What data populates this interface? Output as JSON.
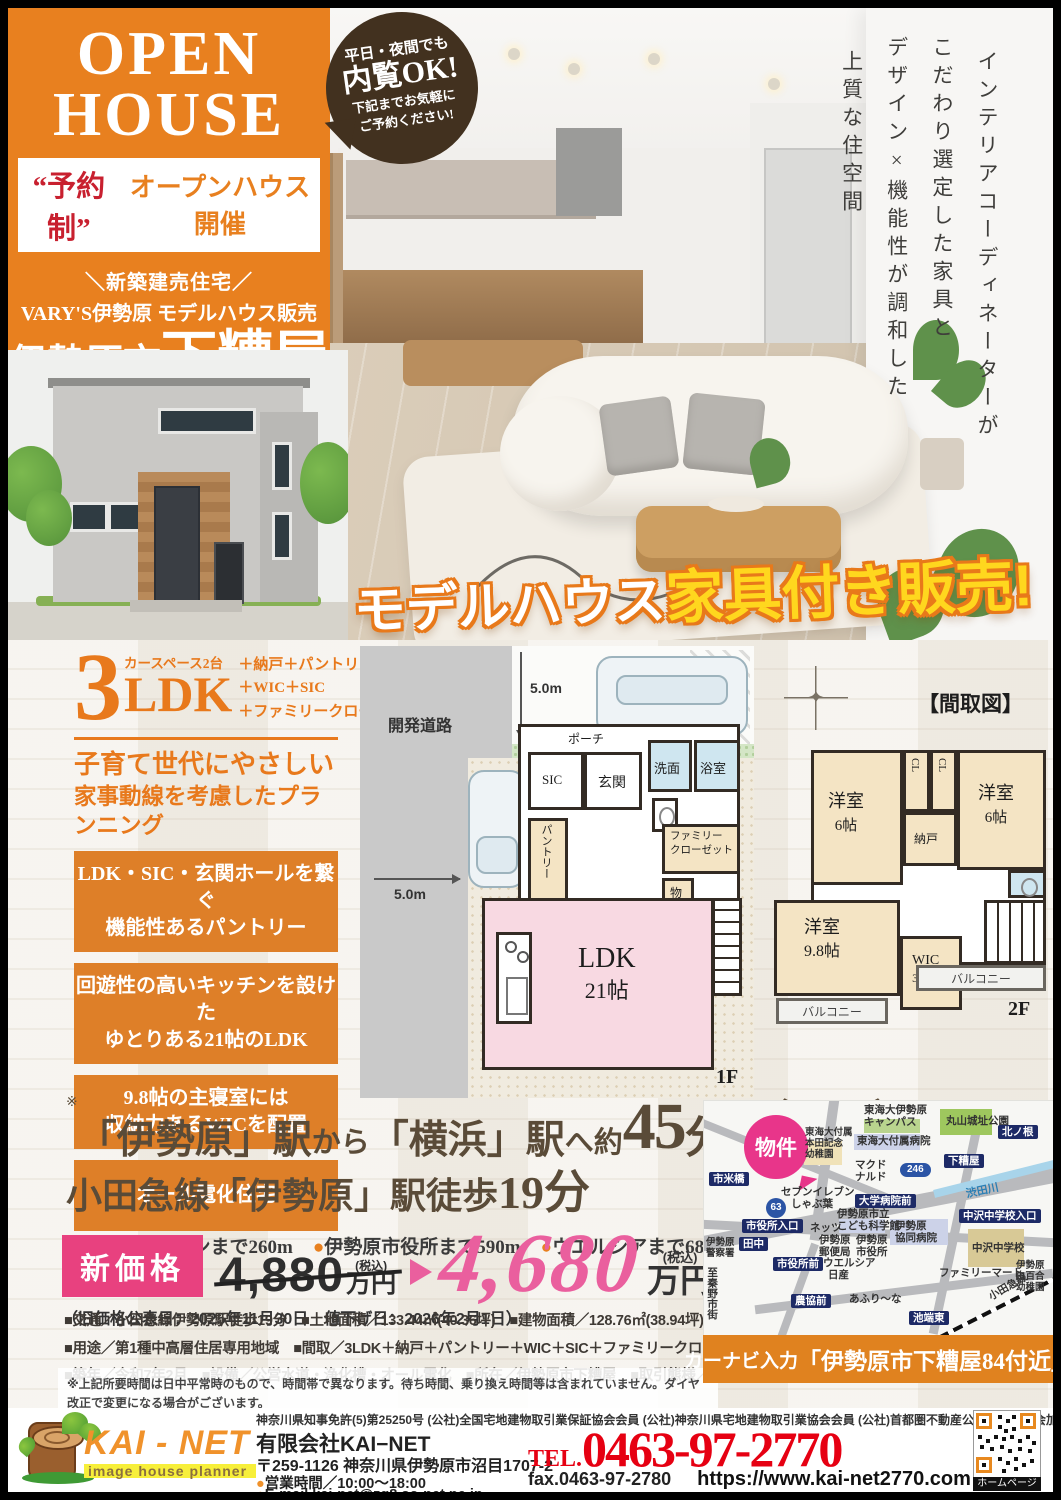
{
  "hero": {
    "open1": "OPEN",
    "open2": "HOUSE",
    "badge1": "平日・夜間でも",
    "badge2": "内覧OK!",
    "badge3": "下記までお気軽に",
    "badge4": "ご予約ください!",
    "yoyaku": "“予約制”",
    "kaisai": "オープンハウス開催",
    "shinchiku": "＼新築建売住宅／",
    "varys": "VARY'S伊勢原 モデルハウス販売",
    "city": "伊勢原市",
    "town": "下糟屋",
    "en": "SHIMOKASUYA ISEHARA CITY",
    "vcopy": [
      "インテリアコーディネーターが",
      "こだわり選定した家具と",
      "デザイン×機能性が調和した",
      "上質な住空間"
    ],
    "furniture_white": "モデルハウス",
    "furniture_yellow": "家具付き販売!"
  },
  "features": {
    "num": "3",
    "ldk": "LDK",
    "car": "カースペース2台",
    "plus1": "＋納戸＋パントリー",
    "plus2": "＋WIC＋SIC",
    "plus3": "＋ファミリークローゼット",
    "catch1": "子育て世代にやさしい",
    "catch2": "家事動線を考慮したプランニング",
    "boxes": [
      {
        "l1": "LDK・SIC・玄関ホールを繋ぐ",
        "l2": "機能性あるパントリー"
      },
      {
        "l1": "回遊性の高いキッチンを設けた",
        "l2": "ゆとりある21帖のLDK"
      },
      {
        "l1": "9.8帖の主寝室には",
        "l2": "収納力あるWICを配置"
      },
      {
        "l1": "オール電化住宅",
        "l2": ""
      }
    ]
  },
  "plan": {
    "title": "【間取図】",
    "road": "開発道路",
    "dim": "5.0m",
    "f1": {
      "porch": "ポーチ",
      "sic": "SIC",
      "genkan": "玄関",
      "senmen": "洗面",
      "bath": "浴室",
      "pantry": "パントリー",
      "fam1": "ファミリー",
      "fam2": "クローゼット",
      "mono": "物",
      "ldk": "LDK",
      "ldk_size": "21帖",
      "floor": "1F"
    },
    "f2": {
      "yo1": "洋室",
      "yo1s": "6帖",
      "yo2": "洋室",
      "yo2s": "6帖",
      "cl1": "CL",
      "cl2": "CL",
      "nando": "納戸",
      "yo3": "洋室",
      "yo3s": "9.8帖",
      "wic": "WIC",
      "wics": "3.7帖",
      "balcony1": "バルコニー",
      "balcony2": "バルコニー",
      "floor": "2F"
    }
  },
  "station": {
    "mark": "※",
    "p1": "「伊勢原」駅",
    "p2": "から",
    "p3": "「横浜」駅",
    "p4": "へ約",
    "big": "45",
    "p5": "分",
    "paren_open": "（",
    "paren_close": "）",
    "paren1": "小田急線利用",
    "paren2": "海老名駅より",
    "paren3": "相鉄本線利用",
    "l2a": "小田急線「伊勢原」駅徒歩",
    "l2b": "19分",
    "bullets": [
      {
        "dot": "●",
        "text": "セブンイレブンまで260m"
      },
      {
        "dot": "●",
        "text": "伊勢原市役所まで590m"
      },
      {
        "dot": "●",
        "text": "ウエルシアまで680m"
      }
    ]
  },
  "price": {
    "tag": "新価格",
    "old": "4,880",
    "old_tax": "(税込)",
    "old_unit": "万円",
    "new": "4,680",
    "new_tax": "(税込)",
    "new_unit": "万円",
    "note": "（旧価格公表日：2025年11月30日　値下げ日：2026年2月1日）"
  },
  "details": {
    "line1": "■交通／小田急線伊勢原駅徒歩19分　■土地面積／133.44㎡(40.36坪)　■建物面積／128.76㎡(38.94坪)　■構造／木造2階建",
    "line2": "■用途／第1種中高層住居専用地域　■間取／3LDK＋納戸＋パントリー＋WIC＋SIC＋ファミリークローゼット",
    "line3": "■築年／令和7年2月　■設備／公営水道・浄化槽・オール電化　■所在／伊勢原市下糟屋　■取引態様／媒介"
  },
  "disclaimer": {
    "line1": "※上記所要時間は日中平常時のもので、時間帯で異なります。待ち時間、乗り換え時間等は含まれていません。ダイヤ改正で変更になる場合がございます。",
    "line2": "■図面と現況が異なる場合は現況を優先します。■徒歩1分＝80m換算です。■広告制作中に売却済みとなった物件に関しましては御容赦下さい。",
    "line3": "■掲載写真は一部加工しております。■広告有効期限／発行より2週間"
  },
  "map": {
    "property": "物件",
    "navi_a": "カーナビ入力",
    "navi_b": "「伊勢原市下糟屋84付近」",
    "labels": [
      {
        "t": "東海大伊勢原\nキャンパス",
        "c": "txt",
        "x": 160,
        "y": 3
      },
      {
        "t": "丸山城址公園",
        "c": "txt",
        "x": 242,
        "y": 14
      },
      {
        "t": "北ノ根",
        "c": "pill",
        "x": 294,
        "y": 24
      },
      {
        "t": "東海大付属\n本田記念\n幼稚園",
        "c": "txt s",
        "x": 101,
        "y": 27
      },
      {
        "t": "東海大付属病院",
        "c": "txt",
        "x": 153,
        "y": 34
      },
      {
        "t": "下糟屋",
        "c": "pill",
        "x": 240,
        "y": 53
      },
      {
        "t": "渋田川",
        "c": "blue",
        "x": 262,
        "y": 84,
        "r": -12
      },
      {
        "t": "市米橋",
        "c": "pill",
        "x": 5,
        "y": 71
      },
      {
        "t": "マクド\nナルド",
        "c": "txt",
        "x": 151,
        "y": 58
      },
      {
        "t": "246",
        "c": "shieldo",
        "x": 196,
        "y": 62
      },
      {
        "t": "セブンイレブン",
        "c": "txt",
        "x": 77,
        "y": 85
      },
      {
        "t": "しゃぶ葉",
        "c": "txt",
        "x": 87,
        "y": 97
      },
      {
        "t": "大学病院前",
        "c": "pill",
        "x": 151,
        "y": 93
      },
      {
        "t": "63",
        "c": "shieldr",
        "x": 62,
        "y": 97
      },
      {
        "t": "中沢中学校入口",
        "c": "pill",
        "x": 255,
        "y": 108
      },
      {
        "t": "市役所入口",
        "c": "pill",
        "x": 38,
        "y": 118
      },
      {
        "t": "ネッツ",
        "c": "txt",
        "x": 106,
        "y": 121
      },
      {
        "t": "伊勢原市立\nこども科学館",
        "c": "txt",
        "x": 133,
        "y": 107
      },
      {
        "t": "伊勢原\n協同病院",
        "c": "txt",
        "x": 191,
        "y": 119
      },
      {
        "t": "田中",
        "c": "pill",
        "x": 35,
        "y": 136
      },
      {
        "t": "伊勢原\n警察署",
        "c": "txt s",
        "x": 2,
        "y": 137
      },
      {
        "t": "伊勢原\n郵便局",
        "c": "txt",
        "x": 115,
        "y": 133
      },
      {
        "t": "伊勢原\n市役所",
        "c": "txt",
        "x": 152,
        "y": 133
      },
      {
        "t": "中沢中学校",
        "c": "txt",
        "x": 268,
        "y": 141
      },
      {
        "t": "市役所前",
        "c": "pill",
        "x": 69,
        "y": 156
      },
      {
        "t": "ウエルシア",
        "c": "txt",
        "x": 119,
        "y": 156
      },
      {
        "t": "日産",
        "c": "txt",
        "x": 124,
        "y": 168
      },
      {
        "t": "ファミリーマート",
        "c": "txt",
        "x": 235,
        "y": 166
      },
      {
        "t": "伊勢原\n白百合\n幼稚園",
        "c": "txt s",
        "x": 312,
        "y": 160
      },
      {
        "t": "農協前",
        "c": "pill",
        "x": 87,
        "y": 193
      },
      {
        "t": "あふり〜な",
        "c": "txt",
        "x": 145,
        "y": 192
      },
      {
        "t": "池端東",
        "c": "pill",
        "x": 205,
        "y": 210
      },
      {
        "t": "小田急線",
        "c": "txt",
        "x": 283,
        "y": 180,
        "r": -30
      },
      {
        "t": "至秦野市街",
        "c": "vert",
        "x": 2,
        "y": 166
      }
    ]
  },
  "footer": {
    "license": "神奈川県知事免許(5)第25250号 (公社)全国宅地建物取引業保証協会会員 (公社)神奈川県宅地建物取引業協会会員 (公社)首都圏不動産公正取引協議会加盟",
    "logo": "KAI - NET",
    "logo_sub": "image house planner",
    "company": "有限会社KAI−NET",
    "address": "〒259-1126 神奈川県伊勢原市沼目1707-2",
    "hours_dot": "●",
    "hours": "営業時間／10:00〜18:00",
    "email_dot": "●",
    "email": "E-mail kai-net@zg8.so-net.ne.jp",
    "tel_label": "TEL.",
    "tel": "0463-97-2770",
    "fax": "fax.0463-97-2780",
    "url": "https://www.kai-net2770.com",
    "qr_caption": "ホームページ"
  }
}
